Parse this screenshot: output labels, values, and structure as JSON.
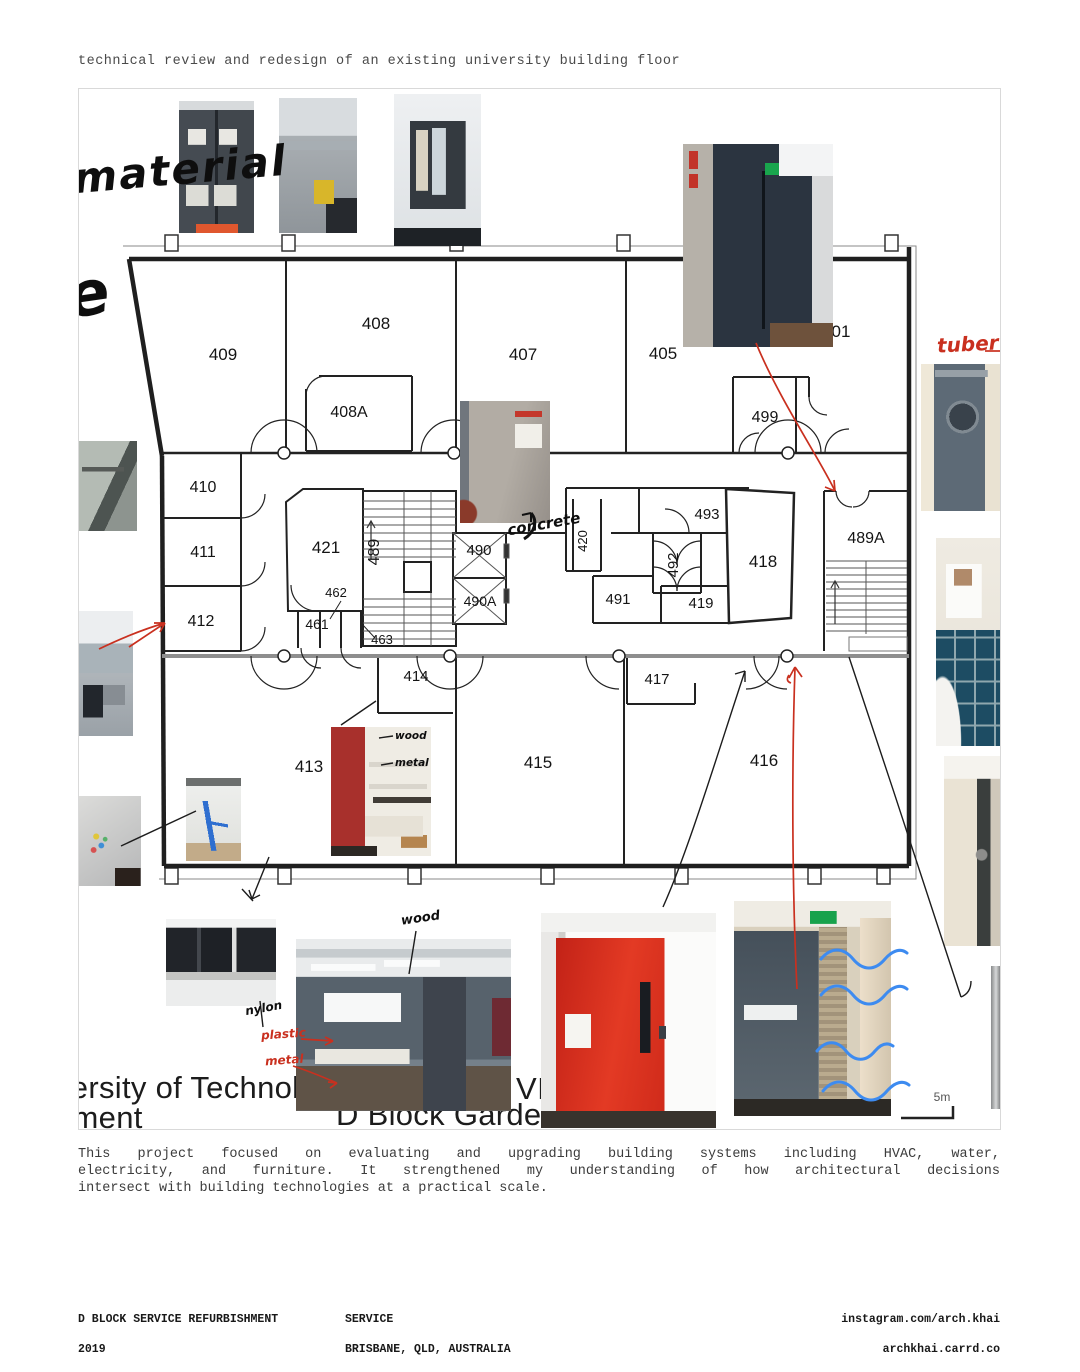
{
  "header": {
    "title": "technical review and redesign of an existing university building floor"
  },
  "description": {
    "line1": "This project focused on evaluating and upgrading building systems including HVAC, water,",
    "line2": "electricity, and furniture. It strengthened my understanding of how architectural decisions",
    "line3": "intersect with building technologies at a practical scale."
  },
  "footer": {
    "project": "D BLOCK SERVICE REFURBISHMENT",
    "year": "2019",
    "category": "SERVICE",
    "location": "BRISBANE, QLD, AUSTRALIA",
    "link1": "instagram.com/arch.khai",
    "link2": "archkhai.carrd.co"
  },
  "collage": {
    "partial_texts": {
      "line1": "versity of Technolog",
      "line2": "ement",
      "fragment_vi": "VI",
      "caption2": "D Block Gardens I"
    },
    "handwritten": {
      "material": "material",
      "script_letter": "e",
      "tuber": "tuber",
      "concrete": "concrete",
      "wood_small": "wood",
      "metal_small": "metal",
      "wood": "wood",
      "nylon": "nylon",
      "plastic": "plastic",
      "metal_red": "metal"
    },
    "colors": {
      "annotation_red": "#c9301f",
      "annotation_blue": "#3d8bf0",
      "ink_black": "#111111"
    }
  },
  "plan": {
    "scale_label": "5m",
    "rooms": [
      {
        "label": "409"
      },
      {
        "label": "408"
      },
      {
        "label": "408A"
      },
      {
        "label": "407"
      },
      {
        "label": "405"
      },
      {
        "label": "499"
      },
      {
        "label": "01"
      },
      {
        "label": "410"
      },
      {
        "label": "411"
      },
      {
        "label": "412"
      },
      {
        "label": "421"
      },
      {
        "label": "489"
      },
      {
        "label": "462"
      },
      {
        "label": "461"
      },
      {
        "label": "463"
      },
      {
        "label": "490"
      },
      {
        "label": "490A"
      },
      {
        "label": "420"
      },
      {
        "label": "493"
      },
      {
        "label": "492"
      },
      {
        "label": "491"
      },
      {
        "label": "419"
      },
      {
        "label": "418"
      },
      {
        "label": "489A"
      },
      {
        "label": "414"
      },
      {
        "label": "417"
      },
      {
        "label": "413"
      },
      {
        "label": "415"
      },
      {
        "label": "416"
      }
    ]
  }
}
